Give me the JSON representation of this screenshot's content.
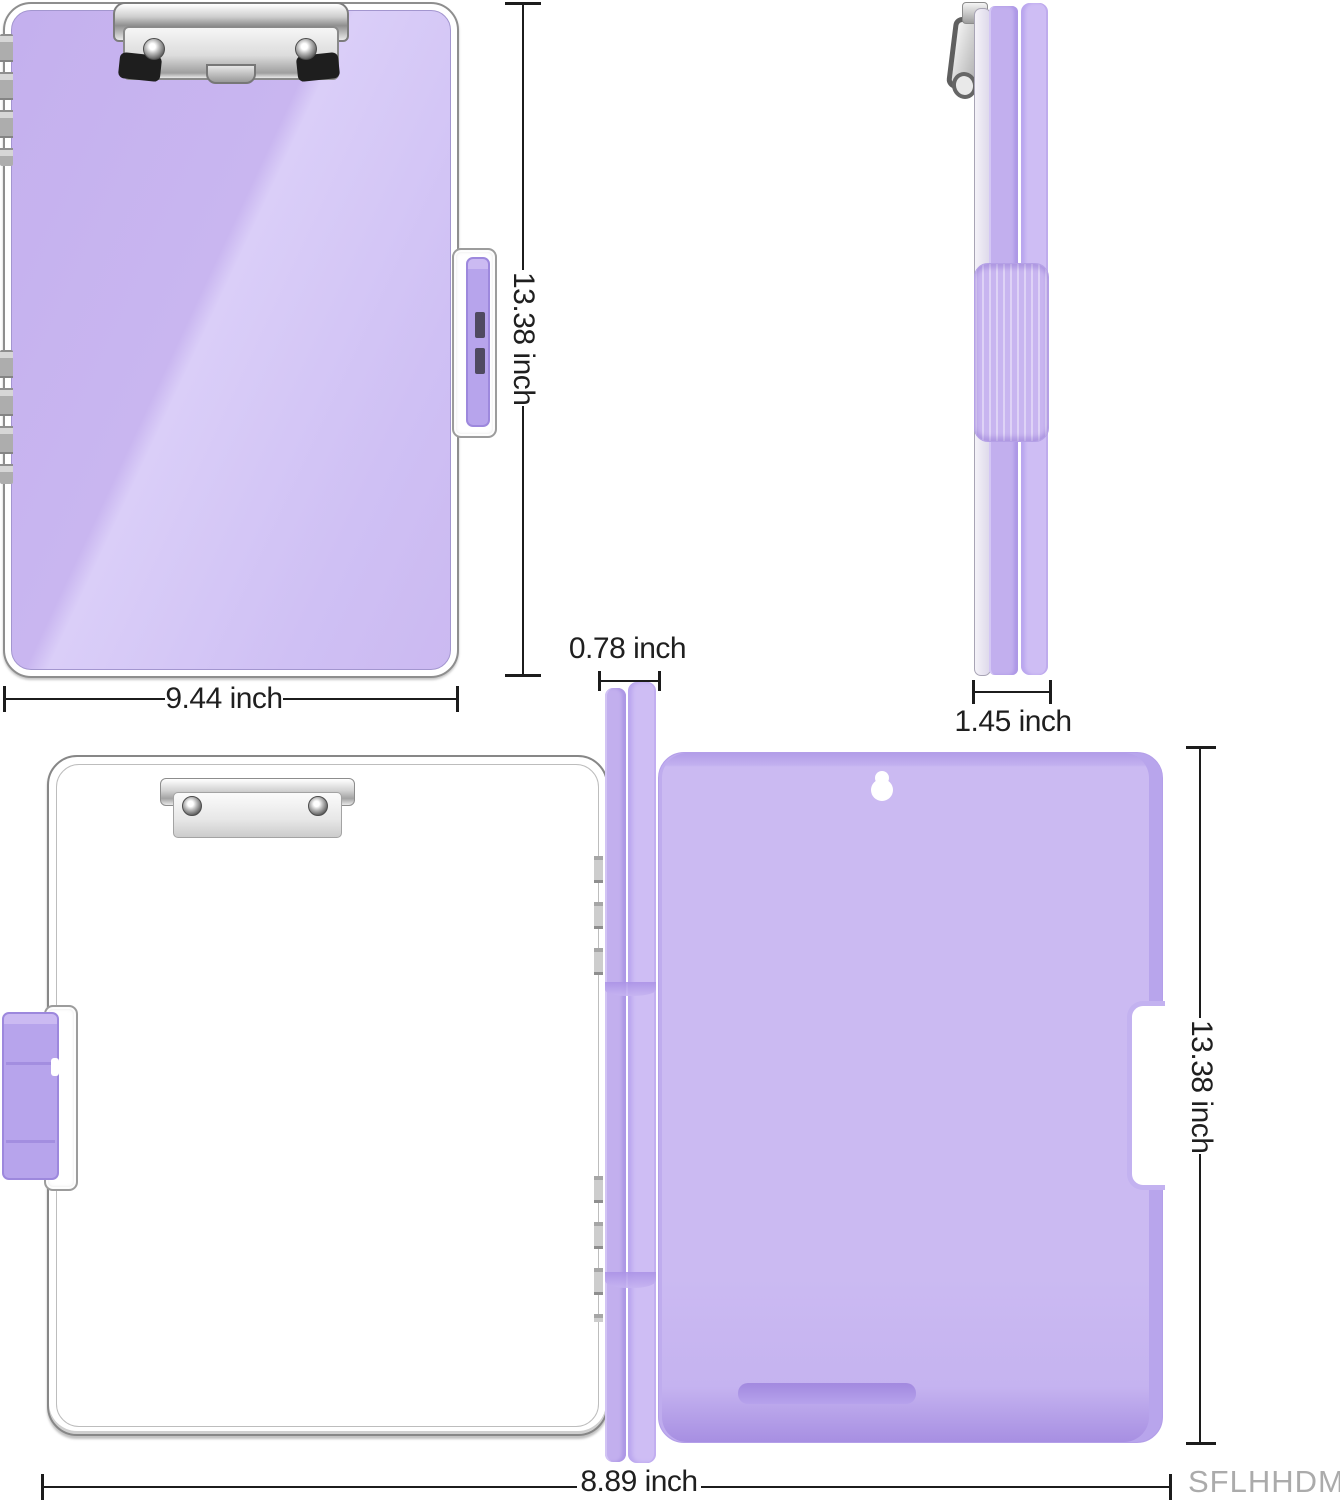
{
  "colors": {
    "board_purple": "#c9b6f0",
    "board_purple_highlight": "#dacef8",
    "spine_purple": "#c2afee",
    "latch_purple": "#b7a4ec",
    "back_panel_purple": "#cbbaf2",
    "back_panel_rim": "#b29de8",
    "metal_silver": "#d2d2d2",
    "dimension_line": "#1c1c1c",
    "label_text": "#1f1f1f",
    "watermark_gray": "#ababab"
  },
  "views": {
    "front": {
      "height_label": "13.38 inch",
      "width_label": "9.44 inch"
    },
    "side": {
      "thickness_label": "1.45 inch"
    },
    "open": {
      "spine_thickness_label": "0.78 inch",
      "width_label": "8.89 inch"
    },
    "back": {
      "height_label": "13.38 inch"
    }
  },
  "watermark": "SFLHHDM"
}
